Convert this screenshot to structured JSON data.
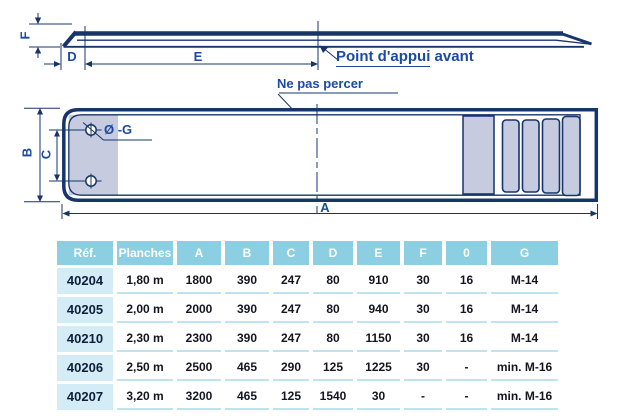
{
  "colors": {
    "line_navy": "#17346b",
    "label_blue": "#1c4aa0",
    "fill_lavender": "#c7cbdf",
    "header_bg": "#8ccfe2",
    "ref_bg": "#d3ecf5",
    "separator": "#bfe3ef",
    "header_text": "#ffffff",
    "ref_text": "#0f1e3c",
    "cell_text": "#15151f"
  },
  "diagram": {
    "side_view": {
      "dim_f": "F",
      "dim_d": "D",
      "dim_e": "E",
      "callout_underlined": "Point d'appui",
      "callout_rest": " avant"
    },
    "plan_view": {
      "dim_b": "B",
      "dim_c": "C",
      "dim_a": "A",
      "hole_label": "Ø -G",
      "note": "Ne pas percer"
    }
  },
  "table": {
    "headers": [
      "Réf.",
      "Planches",
      "A",
      "B",
      "C",
      "D",
      "E",
      "F",
      "0",
      "G"
    ],
    "rows": [
      [
        "40204",
        "1,80 m",
        "1800",
        "390",
        "247",
        "80",
        "910",
        "30",
        "16",
        "M-14"
      ],
      [
        "40205",
        "2,00 m",
        "2000",
        "390",
        "247",
        "80",
        "940",
        "30",
        "16",
        "M-14"
      ],
      [
        "40210",
        "2,30 m",
        "2300",
        "390",
        "247",
        "80",
        "1150",
        "30",
        "16",
        "M-14"
      ],
      [
        "40206",
        "2,50 m",
        "2500",
        "465",
        "290",
        "125",
        "1225",
        "30",
        "-",
        "min. M-16"
      ],
      [
        "40207",
        "3,20 m",
        "3200",
        "465",
        "125",
        "1540",
        "30",
        "-",
        "-",
        "min. M-16"
      ]
    ]
  }
}
